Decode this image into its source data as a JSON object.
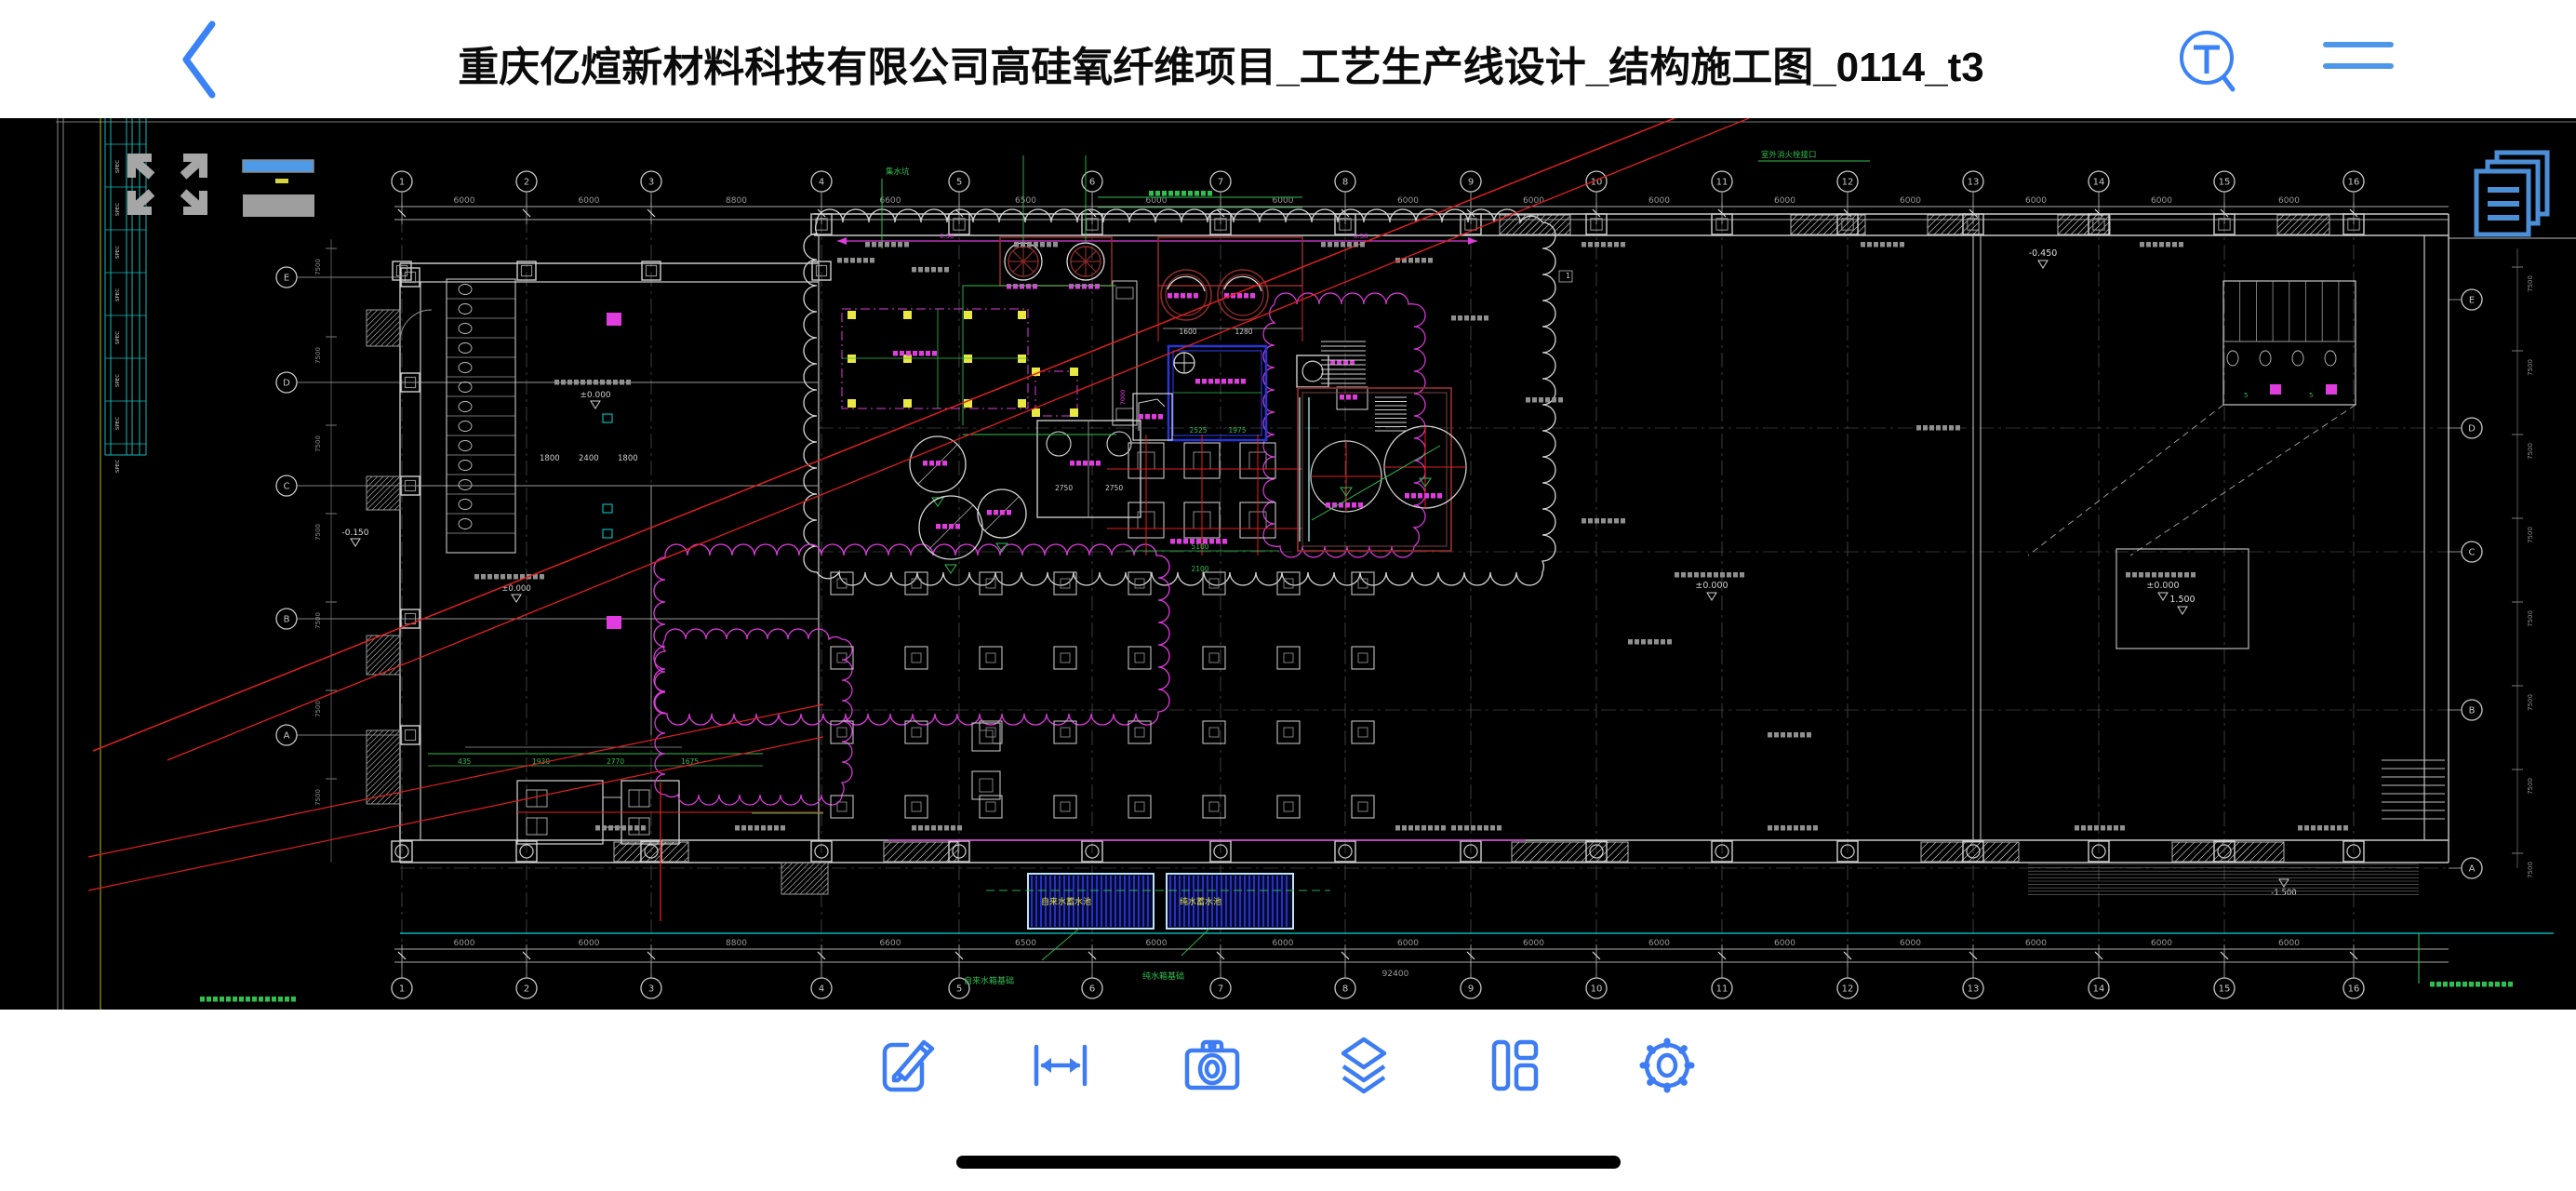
{
  "top_bar": {
    "title": "重庆亿煊新材料科技有限公司高硅氧纤维项目_工艺生产线设计_结构施工图_0114_t3"
  },
  "icons": {
    "back": "chevron-left",
    "find_text": "T-magnifier",
    "menu": "two-line-menu",
    "fullscreen": "expand-arrows",
    "pages": "stacked-pages",
    "edit": "pencil-square",
    "measure": "double-arrow-ruler",
    "snapshot": "camera",
    "layers": "layer-stack",
    "layout": "viewports",
    "settings": "gear"
  },
  "toolbar": {
    "accent": "#3D7CF2",
    "items": [
      {
        "name": "edit"
      },
      {
        "name": "measure"
      },
      {
        "name": "snapshot"
      },
      {
        "name": "layers"
      },
      {
        "name": "layout"
      },
      {
        "name": "settings"
      }
    ]
  },
  "drawing": {
    "axes": {
      "top": [
        "1",
        "2",
        "3",
        "4",
        "5",
        "6",
        "7",
        "8",
        "9",
        "10",
        "11",
        "12",
        "13",
        "14",
        "15",
        "16"
      ],
      "bottom": [
        "1",
        "2",
        "3",
        "4",
        "5",
        "6",
        "7",
        "8",
        "9",
        "10",
        "11",
        "12",
        "13",
        "14",
        "15",
        "16"
      ],
      "left": [
        "E",
        "D",
        "C",
        "B",
        "A"
      ],
      "right": [
        "E",
        "D",
        "C",
        "B",
        "A"
      ]
    },
    "dimensions": {
      "top_bays": [
        "6000",
        "6000",
        "8800",
        "6600",
        "6500",
        "6000",
        "6000",
        "6000",
        "6000",
        "6000",
        "6000",
        "6000",
        "6000",
        "6000",
        "6000"
      ],
      "bottom_bays": [
        "6000",
        "6000",
        "8800",
        "6600",
        "6500",
        "6000",
        "6000",
        "6000",
        "6000",
        "6000",
        "6000",
        "6000",
        "6000",
        "6000",
        "6000"
      ],
      "bottom_total": "92400",
      "left_block": [
        "1800",
        "2400",
        "1800"
      ],
      "mcc_row": [
        "435",
        "1930",
        "2770",
        "1675"
      ],
      "blue_room": [
        "2525",
        "1975"
      ],
      "tank_row": [
        "1600",
        "1280"
      ],
      "pump_grid": [
        "5100",
        "2100"
      ],
      "pool_row": [
        "6500",
        "6000",
        "6000",
        "6000"
      ]
    },
    "elevations": {
      "zero": "±0.000",
      "neg_450": "-0.450",
      "neg_150": "-0.150",
      "pos_1500": "1.500",
      "neg_1500": "-1.500"
    },
    "labels": {
      "pool1": "自来水蓄水池",
      "pool2": "纯水蓄水池",
      "pool1_leader": "自来水箱基础",
      "pool2_leader": "纯水箱基础",
      "sump": "集水坑"
    },
    "colors": {
      "background": "#000000",
      "line": "#C9C9C9",
      "dim": "#9A9A9A",
      "green": "#2FBF4F",
      "magenta": "#E03CE0",
      "red": "#E02020",
      "dark_red": "#8C2B2B",
      "blue": "#2A35D0",
      "pool_border": "#BFE3F7",
      "pool_hatch": "#2430C8",
      "yellow": "#E8E840",
      "cyan": "#00D8D8",
      "olive": "#9C9C00"
    }
  },
  "home_indicator": {
    "color": "#000000"
  }
}
